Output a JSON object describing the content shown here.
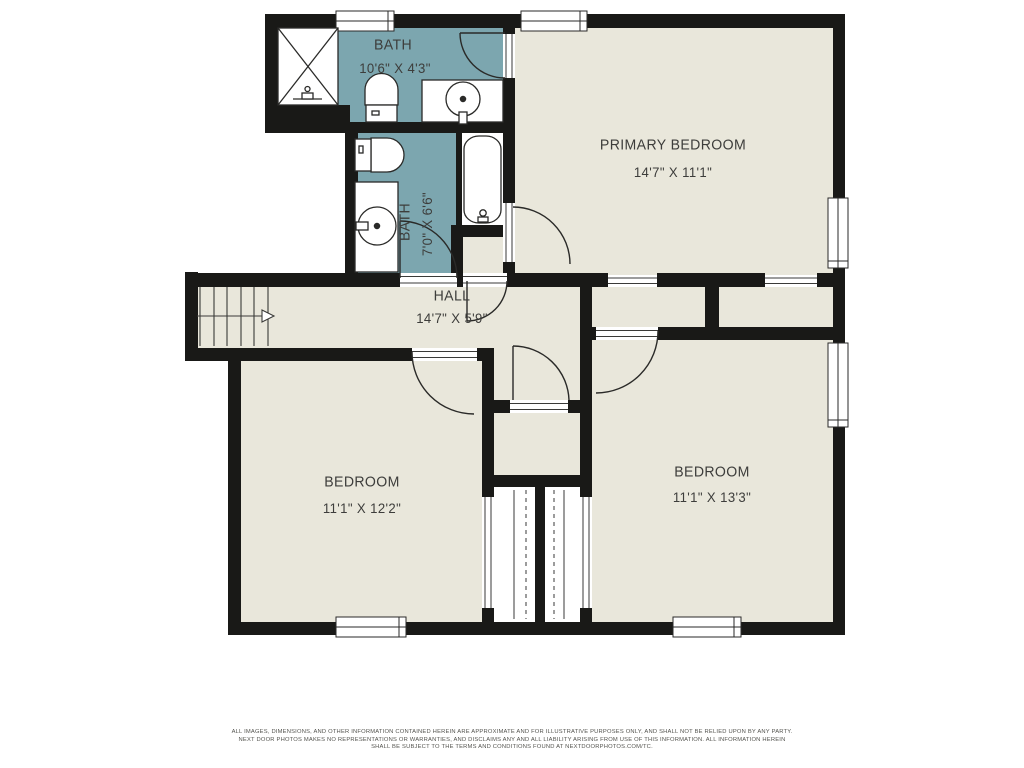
{
  "rooms": {
    "bath1": {
      "name": "BATH",
      "dims": "10'6\" X 4'3\""
    },
    "bath2": {
      "name": "BATH",
      "dims": "7'0\" X 6'6\""
    },
    "primary": {
      "name": "PRIMARY BEDROOM",
      "dims": "14'7\" X 11'1\""
    },
    "hall": {
      "name": "HALL",
      "dims": "14'7\" X 5'9\""
    },
    "bedroom1": {
      "name": "BEDROOM",
      "dims": "11'1\" X 12'2\""
    },
    "bedroom2": {
      "name": "BEDROOM",
      "dims": "11'1\" X 13'3\""
    }
  },
  "disclaimer": {
    "line1": "ALL IMAGES, DIMENSIONS, AND OTHER INFORMATION CONTAINED HEREIN ARE APPROXIMATE AND FOR ILLUSTRATIVE PURPOSES ONLY, AND SHALL NOT BE RELIED UPON BY ANY PARTY.",
    "line2": "NEXT DOOR PHOTOS MAKES NO REPRESENTATIONS OR WARRANTIES, AND DISCLAIMS ANY AND ALL LIABILITY ARISING FROM USE OF THIS INFORMATION. ALL INFORMATION HEREIN",
    "line3": "SHALL BE SUBJECT TO THE TERMS AND CONDITIONS FOUND AT NEXTDOORPHOTOS.COM/TC."
  },
  "colors": {
    "bath_floor": "#7ca6af",
    "room_floor": "#e9e7db",
    "wall": "#191917",
    "fixture_line": "#2a2a28",
    "label_text": "#3d3d3b"
  }
}
